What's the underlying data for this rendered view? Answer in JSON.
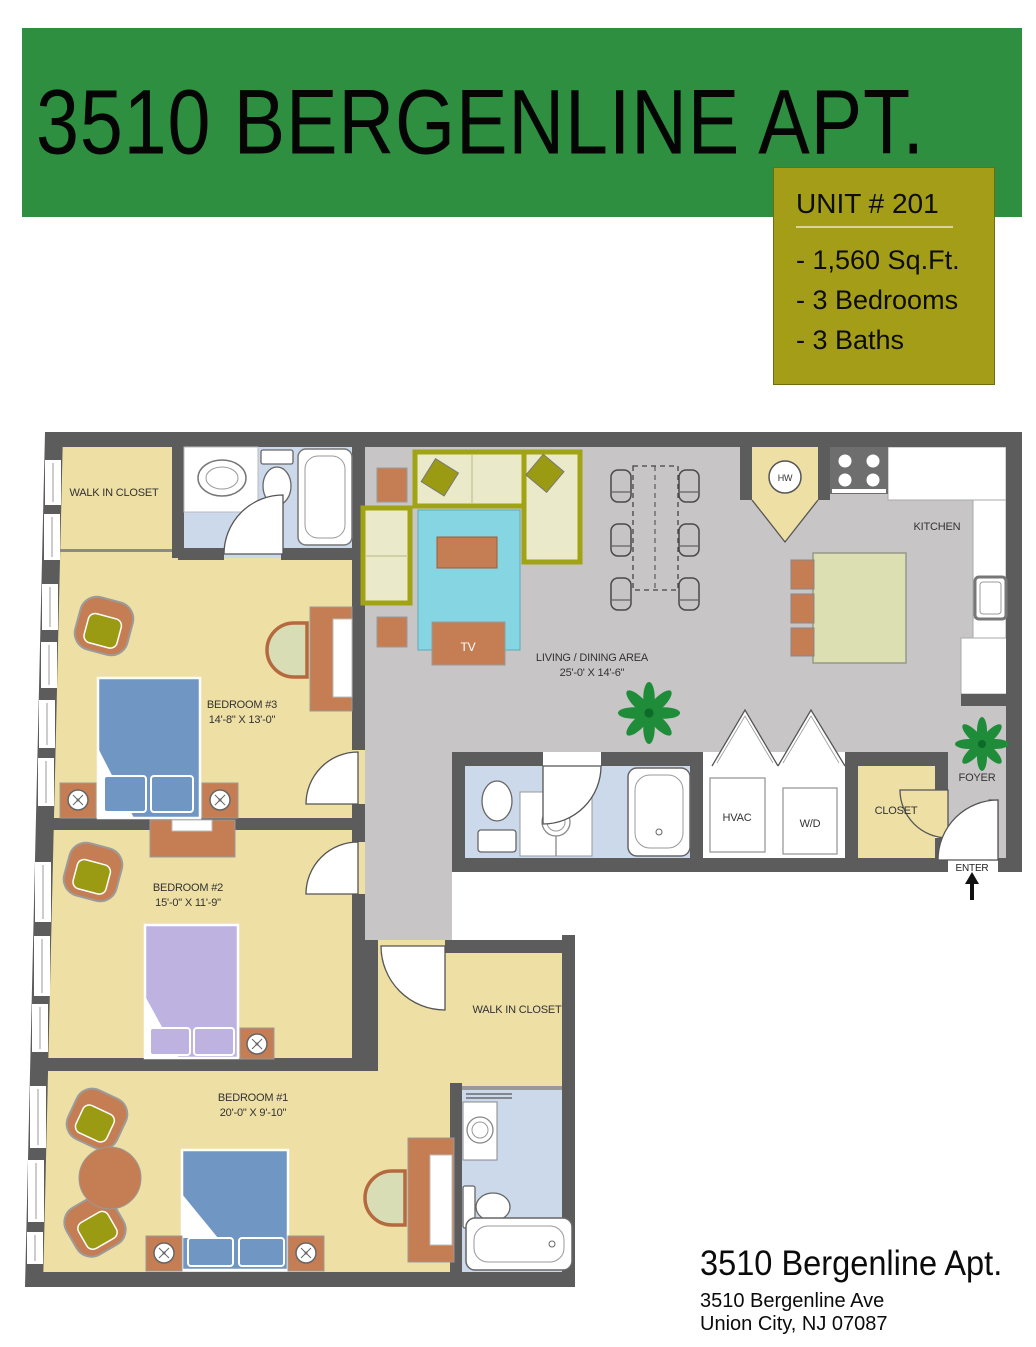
{
  "banner": {
    "title": "3510 BERGENLINE APT."
  },
  "unit_box": {
    "title": "UNIT # 201",
    "lines": [
      "- 1,560 Sq.Ft.",
      "- 3 Bedrooms",
      "- 3 Baths"
    ]
  },
  "rooms": {
    "wic_top": {
      "label": "WALK IN CLOSET"
    },
    "bedroom3": {
      "label": "BEDROOM #3",
      "dims": "14'-8\" X 13'-0\""
    },
    "bedroom2": {
      "label": "BEDROOM #2",
      "dims": "15'-0\" X 11'-9\""
    },
    "bedroom1": {
      "label": "BEDROOM #1",
      "dims": "20'-0\" X 9'-10\""
    },
    "living": {
      "label": "LIVING / DINING AREA",
      "dims": "25'-0' X 14'-6\""
    },
    "kitchen": {
      "label": "KITCHEN"
    },
    "foyer": {
      "label": "FOYER"
    },
    "closet": {
      "label": "CLOSET"
    },
    "wic_bottom": {
      "label": "WALK IN CLOSET"
    },
    "hvac": {
      "label": "HVAC"
    },
    "wd": {
      "label": "W/D"
    },
    "hw": {
      "label": "HW"
    },
    "enter": {
      "label": "ENTER"
    },
    "tv": {
      "label": "TV"
    }
  },
  "footer": {
    "title": "3510 Bergenline Apt.",
    "address1": "3510 Bergenline Ave",
    "address2": "Union City, NJ 07087"
  },
  "colors": {
    "banner_green": "#2e8f41",
    "unit_box_olive": "#a49d17",
    "wall_gray": "#5d5c5c",
    "floor_yellow": "#eedfa4",
    "floor_gray": "#c7c5c5",
    "floor_blue": "#ccd9eb",
    "furniture_orange": "#c57e53",
    "accent_olive": "#9b9b13",
    "bed_blue": "#7097c4",
    "bed_lavender": "#beb3e0",
    "rug_cyan": "#86d5e2",
    "island_green": "#dbdfb2",
    "plant_green": "#1f8c3a"
  }
}
